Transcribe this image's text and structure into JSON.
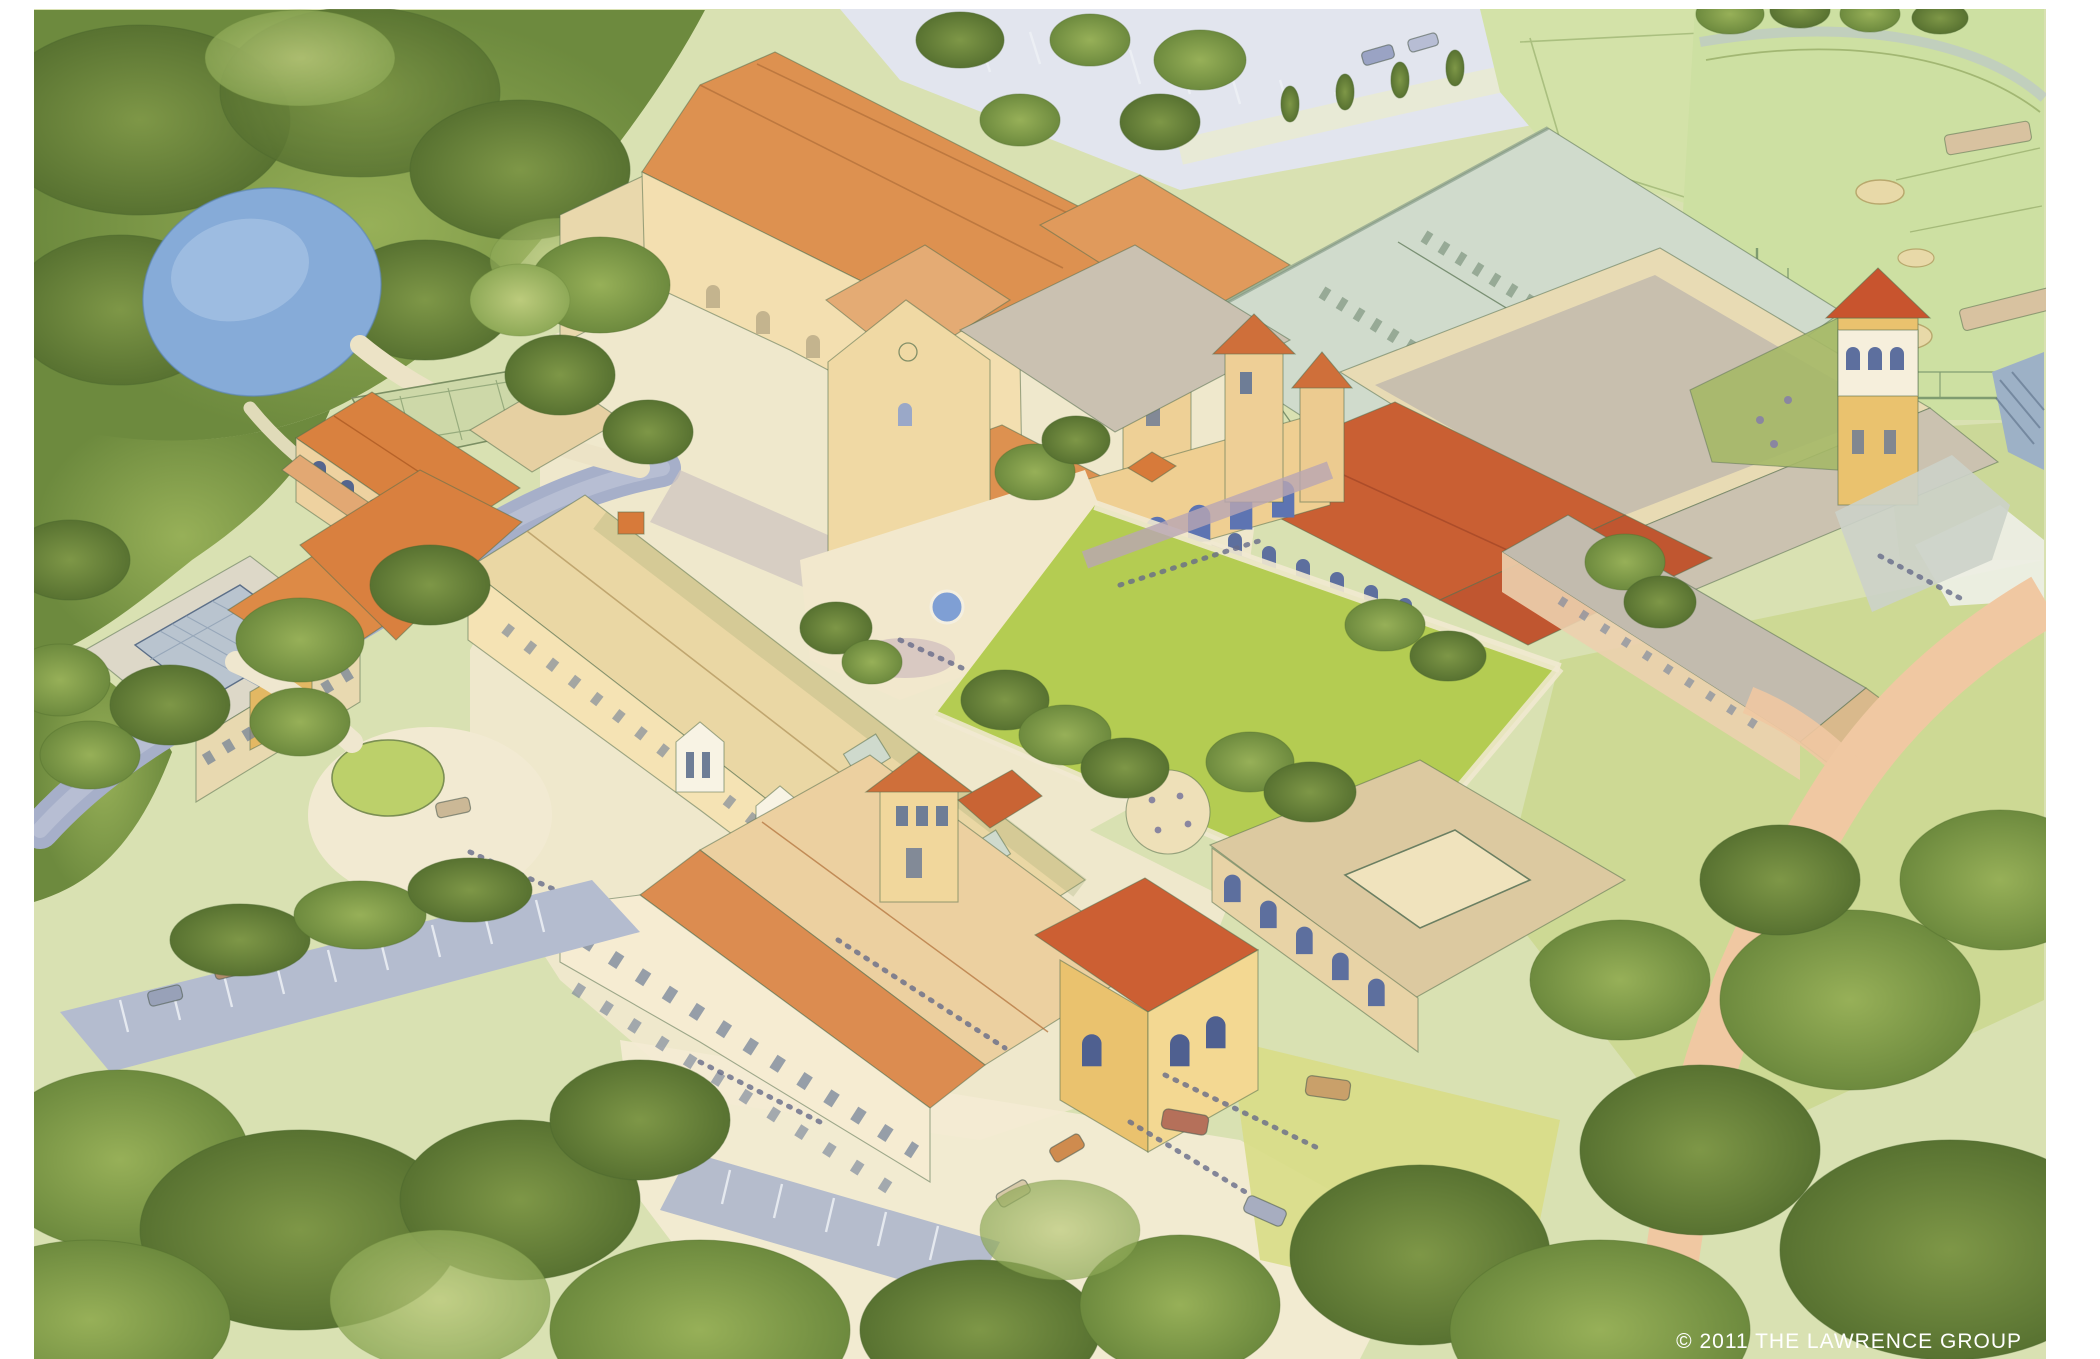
{
  "image": {
    "description": "Watercolor aerial perspective rendering of a school campus: tile-roofed buildings around a green quad, a large field house, baseball and practice fields, a pond, a creek, tree groves, roads and parking areas.",
    "medium": "watercolor architectural site rendering"
  },
  "footer": {
    "copyright": "© 2011 THE LAWRENCE GROUP"
  },
  "palette": {
    "paper": "#ffffff",
    "canopy_dark": "#637f35",
    "canopy_mid": "#819c48",
    "canopy_light": "#a3b964",
    "lawn": "#cdd994",
    "quad_green": "#b4cc52",
    "field_green": "#d3e2a8",
    "ballfield_green": "#cde0a2",
    "pond_blue": "#86abd8",
    "creek_gray": "#a6afc9",
    "parking_gray": "#b4bccf",
    "path_cream": "#f2ead2",
    "road_peach": "#f0c8a2",
    "roof_orange": "#dd9150",
    "roof_red": "#c95f33",
    "roof_salmon": "#e4ab74",
    "roof_tan": "#ead7a4",
    "roof_flat": "#c8bfae",
    "roof_fieldhouse": "#d0dbcc",
    "wall_tan": "#f3dfb0",
    "wall_yellow": "#eac26e",
    "wall_cream": "#f6eed6",
    "window_blue": "#6f84b8",
    "ink": "#55704e",
    "copyright_text": "#ffffff"
  }
}
